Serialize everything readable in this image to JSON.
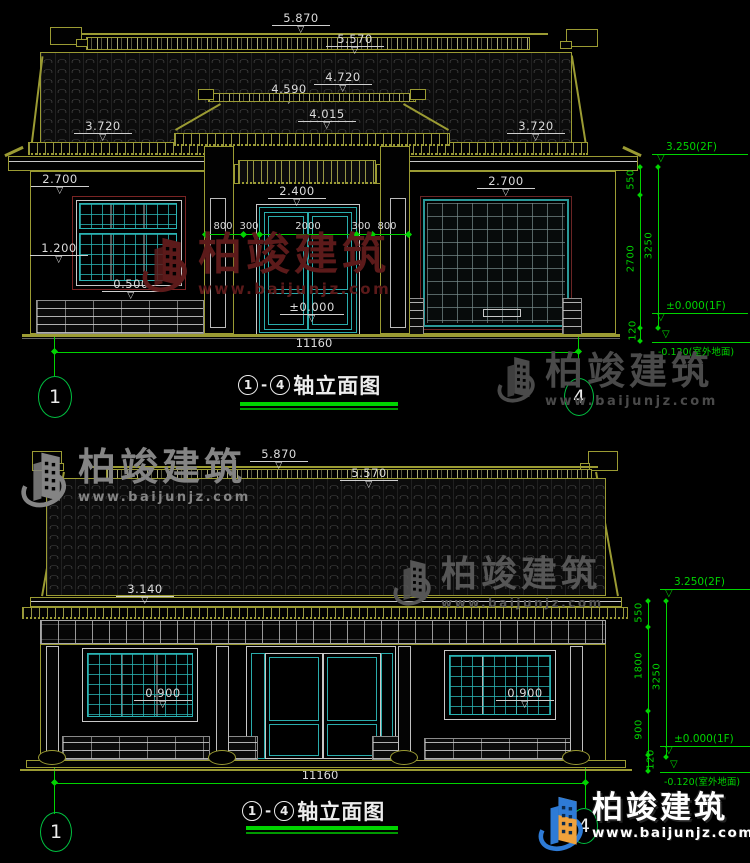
{
  "watermarks": {
    "brand": "柏竣建筑",
    "url": "www.baijunjz.com"
  },
  "logo": {
    "brand": "柏竣建筑",
    "url": "www.baijunjz.com"
  },
  "top": {
    "title": {
      "axis_start": "1",
      "dash": "-",
      "axis_end": "4",
      "text": "轴立面图"
    },
    "axes": {
      "left": "1",
      "right": "4"
    },
    "dims": {
      "d5870": "5.870",
      "d5570": "5.570",
      "d4720": "4.720",
      "d4590": "4.590",
      "d4015": "4.015",
      "d3720_left": "3.720",
      "d3720_right": "3.720",
      "d2700_left": "2.700",
      "d2700_right": "2.700",
      "d2400": "2.400",
      "d1200": "1.200",
      "d0500": "0.500",
      "zero": "±0.000",
      "w800_a": "800",
      "w300_a": "300",
      "w2000": "2000",
      "w300_b": "300",
      "w800_b": "800",
      "total": "11160"
    },
    "levels": {
      "floor2": "3.250(2F)",
      "floor1": "±0.000(1F)",
      "outdoor": "-0.120(室外地面)",
      "v550": "550",
      "v2700": "2700",
      "v3250": "3250",
      "v120": "120"
    }
  },
  "bottom": {
    "title": {
      "axis_start": "1",
      "dash": "-",
      "axis_end": "4",
      "text": "轴立面图"
    },
    "axes": {
      "left": "1",
      "right": "4"
    },
    "dims": {
      "d5870": "5.870",
      "d5570": "5.570",
      "d3140": "3.140",
      "d0900_left": "0.900",
      "d0900_right": "0.900",
      "total": "11160"
    },
    "levels": {
      "floor2": "3.250(2F)",
      "floor1": "±0.000(1F)",
      "outdoor": "-0.120(室外地面)",
      "v550": "550",
      "v1800": "1800",
      "v900": "900",
      "v3250": "3250",
      "v120": "120"
    }
  }
}
